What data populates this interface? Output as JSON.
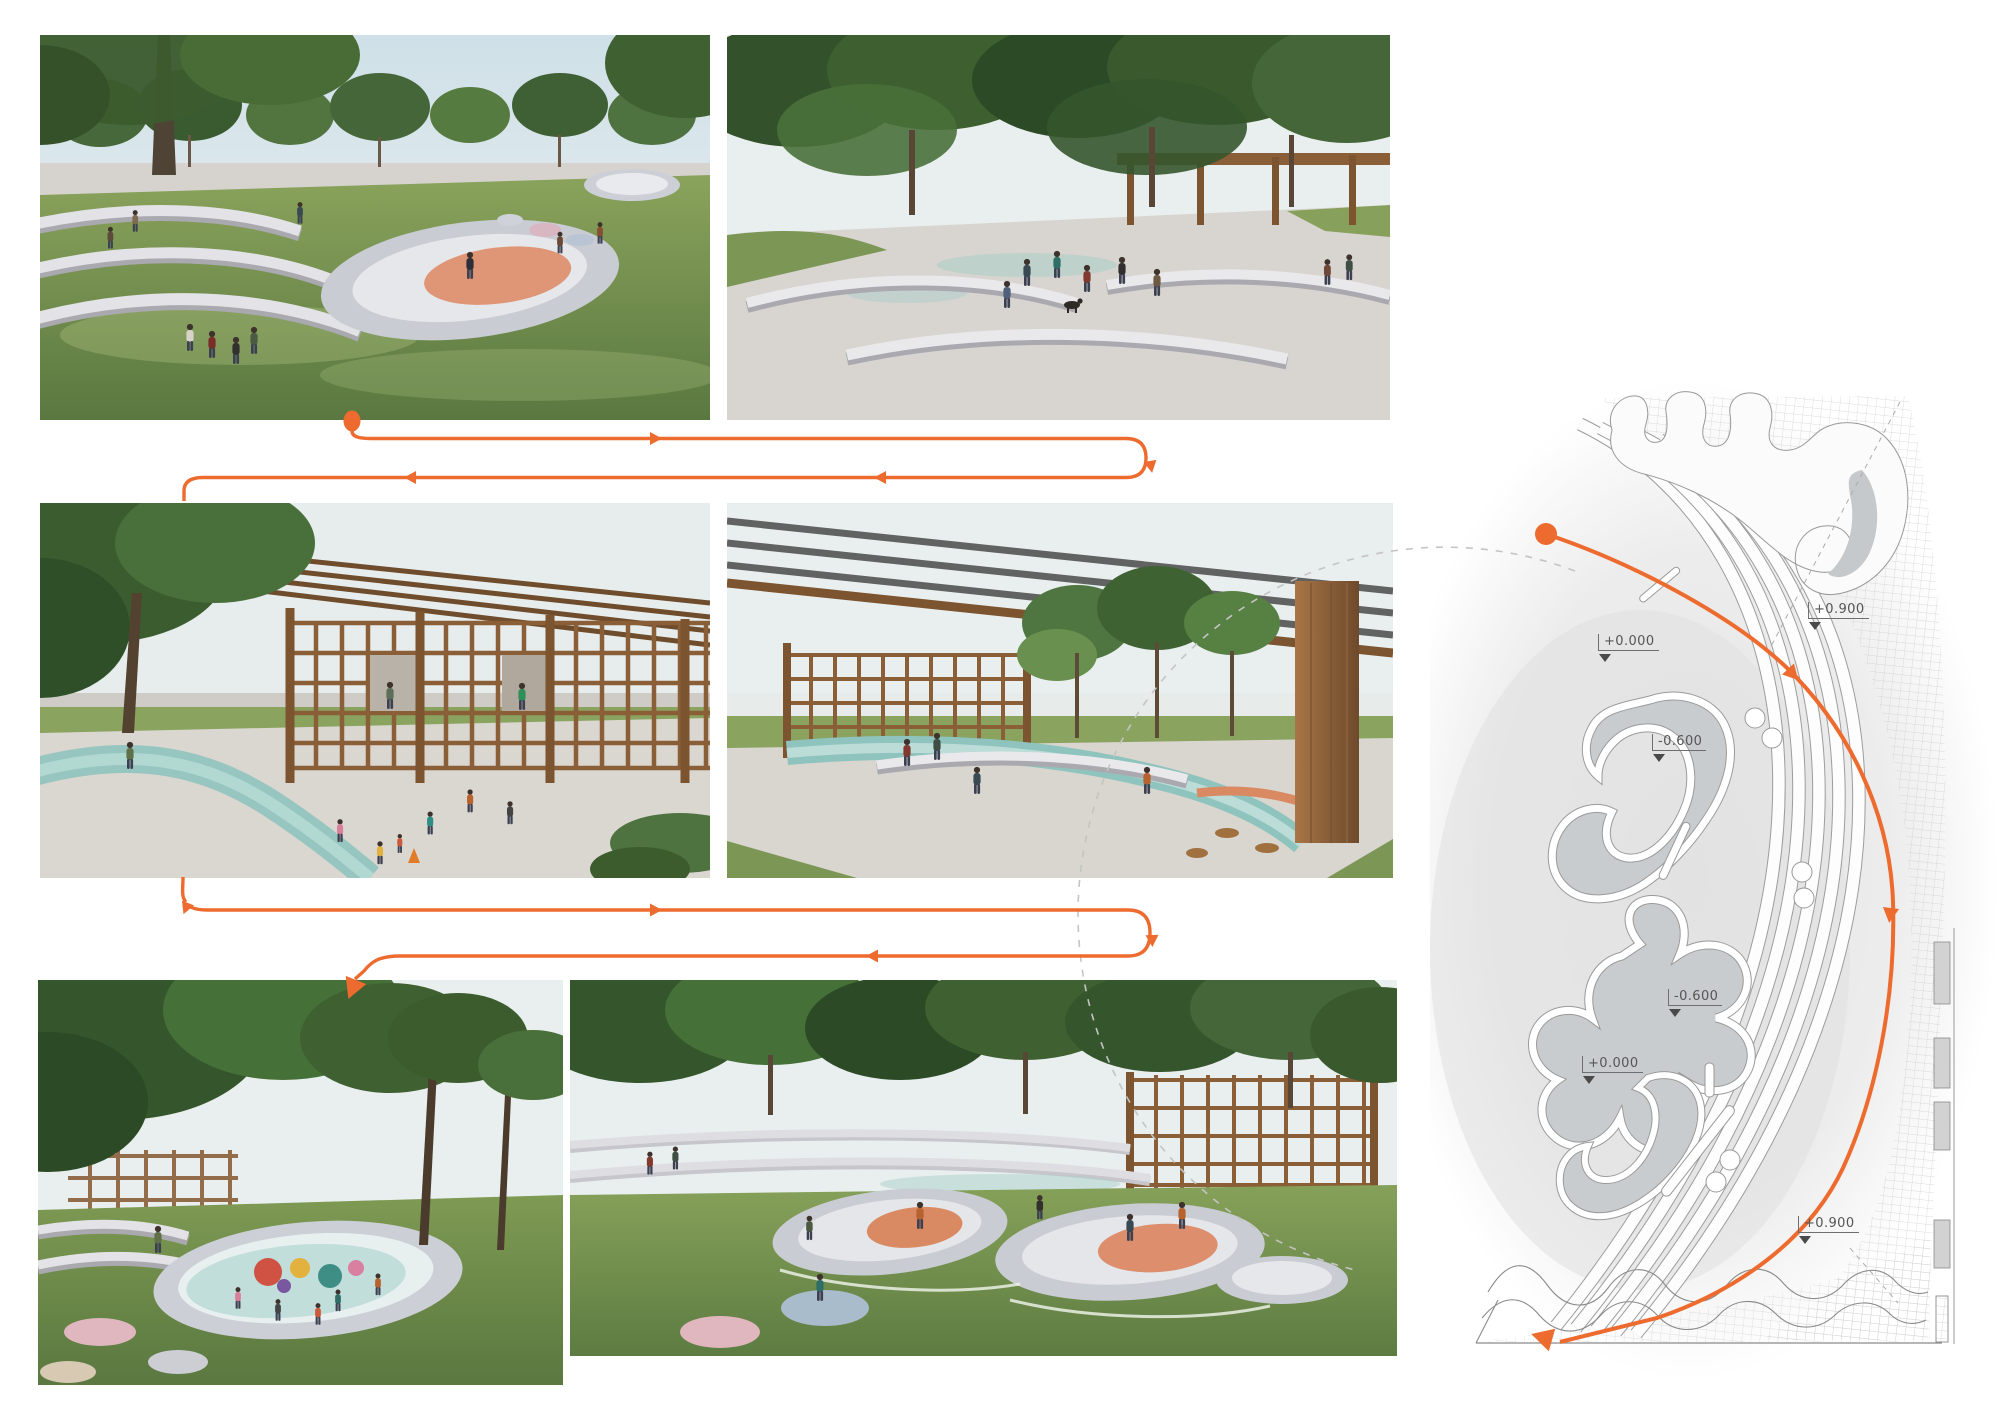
{
  "board": {
    "background": "#ffffff"
  },
  "colors": {
    "accent_orange": "#ED6B2E",
    "dashed_gray": "#C4C4C4",
    "plan_line_gray": "#8F8F8F",
    "label_gray": "#555555"
  },
  "renders": [
    {
      "id": "render-1",
      "alt": "Terraced lawn amphitheatre with organic concrete skate bowl and visitors"
    },
    {
      "id": "render-2",
      "alt": "Tree canopy plaza with curved benches, pergola, people and a dog"
    },
    {
      "id": "render-3",
      "alt": "Timber lattice pavilion with winding blue-green play path and children"
    },
    {
      "id": "render-4",
      "alt": "Timber colonnade walkway with teal stream, curved seating and trees"
    },
    {
      "id": "render-5",
      "alt": "Play pool bowl with colourful play sculptures under dense trees"
    },
    {
      "id": "render-6",
      "alt": "Cluster of skate bowls with terracotta surfacing, skaters and round poufs"
    }
  ],
  "plan": {
    "name": "site-plan",
    "levels": [
      {
        "text": "+0.900"
      },
      {
        "text": "+0.000"
      },
      {
        "text": "-0.600"
      },
      {
        "text": "-0.600"
      },
      {
        "text": "+0.000"
      },
      {
        "text": "+0.900"
      }
    ]
  }
}
